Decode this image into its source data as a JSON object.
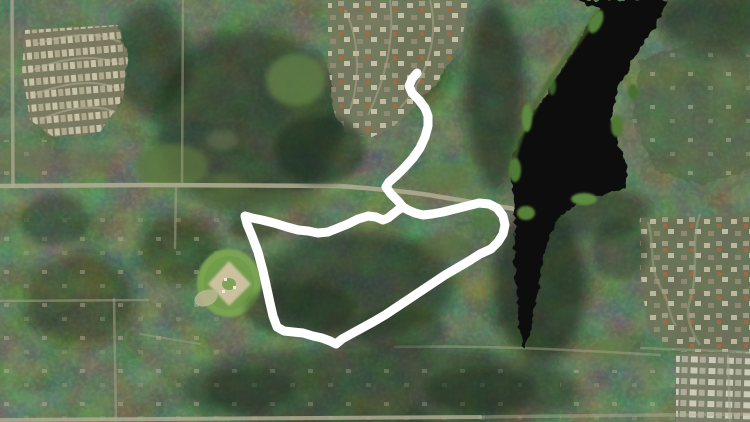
{
  "window": {
    "width": 750,
    "height": 422
  },
  "map": {
    "kind": "satellite-aerial-imagery",
    "description": "Aerial photo of a forested suburban area: dark lake at right, mobile-home park at top-left, dense subdivision at top-center, subdivisions at bottom-right, baseball field at left-center, main roads crossing, with a white GPS activity route drawn on top",
    "colors": {
      "forest_base": "#283522",
      "water": "#0c110b",
      "field_green": "#79a351",
      "infield_tan": "#cbc19f",
      "road": "#b3ae95",
      "houses_light": "#cdc6ab"
    },
    "features": [
      {
        "name": "lake"
      },
      {
        "name": "ball-field"
      },
      {
        "name": "mobile-home-park"
      },
      {
        "name": "subdivision-north"
      },
      {
        "name": "subdivision-southeast"
      },
      {
        "name": "main-road"
      },
      {
        "name": "forest"
      }
    ]
  },
  "route": {
    "color": "#ffffff",
    "stroke_width": 9,
    "points": [
      [
        417,
        73
      ],
      [
        412,
        79
      ],
      [
        409,
        86
      ],
      [
        412,
        93
      ],
      [
        419,
        100
      ],
      [
        425,
        108
      ],
      [
        428,
        116
      ],
      [
        428,
        126
      ],
      [
        425,
        137
      ],
      [
        420,
        148
      ],
      [
        413,
        158
      ],
      [
        405,
        167
      ],
      [
        397,
        175
      ],
      [
        389,
        182
      ],
      [
        386,
        187
      ],
      [
        391,
        194
      ],
      [
        398,
        201
      ],
      [
        403,
        207
      ],
      [
        398,
        210
      ],
      [
        393,
        214
      ],
      [
        388,
        218
      ],
      [
        383,
        220
      ],
      [
        376,
        217
      ],
      [
        368,
        216
      ],
      [
        358,
        219
      ],
      [
        348,
        224
      ],
      [
        338,
        228
      ],
      [
        328,
        232
      ],
      [
        318,
        233
      ],
      [
        308,
        231
      ],
      [
        298,
        230
      ],
      [
        287,
        227
      ],
      [
        274,
        223
      ],
      [
        262,
        220
      ],
      [
        252,
        218
      ],
      [
        245,
        216
      ],
      [
        247,
        224
      ],
      [
        252,
        236
      ],
      [
        258,
        252
      ],
      [
        263,
        271
      ],
      [
        267,
        289
      ],
      [
        270,
        303
      ],
      [
        273,
        316
      ],
      [
        277,
        327
      ],
      [
        284,
        331
      ],
      [
        293,
        332
      ],
      [
        303,
        333
      ],
      [
        313,
        336
      ],
      [
        322,
        338
      ],
      [
        330,
        341
      ],
      [
        336,
        344
      ],
      [
        342,
        339
      ],
      [
        351,
        334
      ],
      [
        362,
        328
      ],
      [
        373,
        322
      ],
      [
        385,
        315
      ],
      [
        397,
        307
      ],
      [
        409,
        299
      ],
      [
        421,
        291
      ],
      [
        433,
        283
      ],
      [
        445,
        275
      ],
      [
        457,
        268
      ],
      [
        469,
        261
      ],
      [
        480,
        254
      ],
      [
        491,
        249
      ],
      [
        498,
        242
      ],
      [
        503,
        234
      ],
      [
        505,
        225
      ],
      [
        503,
        216
      ],
      [
        497,
        208
      ],
      [
        489,
        204
      ],
      [
        479,
        203
      ],
      [
        467,
        206
      ],
      [
        455,
        209
      ],
      [
        443,
        212
      ],
      [
        432,
        214
      ],
      [
        423,
        215
      ],
      [
        415,
        213
      ],
      [
        408,
        210
      ],
      [
        403,
        207
      ]
    ]
  }
}
